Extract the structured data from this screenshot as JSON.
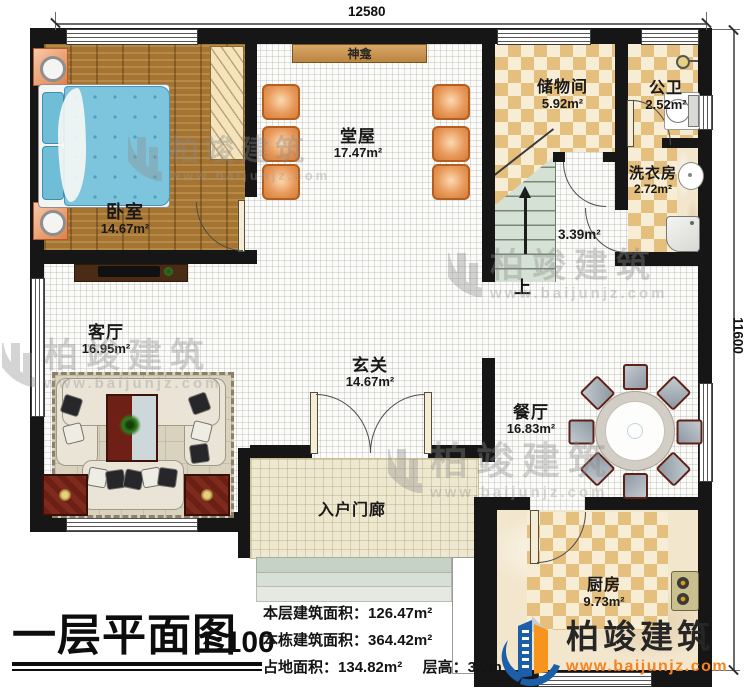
{
  "dimensions": {
    "top": "12580",
    "right": "11600"
  },
  "rooms": {
    "bedroom": {
      "name": "卧室",
      "area": "14.67m²"
    },
    "hall": {
      "name": "堂屋",
      "area": "17.47m²"
    },
    "shrine": {
      "name": "神龛"
    },
    "storage": {
      "name": "储物间",
      "area": "5.92m²"
    },
    "public_bath": {
      "name": "公卫",
      "area": "2.52m²"
    },
    "laundry": {
      "name": "洗衣房",
      "area": "2.72m²"
    },
    "stairwell": {
      "area": "3.39m²",
      "direction": "上"
    },
    "living": {
      "name": "客厅",
      "area": "16.95m²"
    },
    "foyer": {
      "name": "玄关",
      "area": "14.67m²"
    },
    "dining": {
      "name": "餐厅",
      "area": "16.83m²"
    },
    "kitchen": {
      "name": "厨房",
      "area": "9.73m²"
    },
    "porch": {
      "name": "入户门廊"
    }
  },
  "title_block": {
    "title": "一层平面图",
    "scale": "1:100"
  },
  "stats": {
    "floor_area": {
      "label": "本层建筑面积：",
      "value": "126.47m²"
    },
    "total_area": {
      "label": "本栋建筑面积：",
      "value": "364.42m²"
    },
    "footprint": {
      "label": "占地面积：",
      "value": "134.82m²"
    },
    "story_height": {
      "label": "层高：",
      "value": "3.9m"
    }
  },
  "branding": {
    "company": "柏竣建筑",
    "website": "www.baijunjz.com"
  },
  "watermark": {
    "company": "柏竣建筑",
    "website": "www.baijunjz.com"
  },
  "colors": {
    "brand_blue": "#1c5fa8",
    "brand_orange": "#f7941d",
    "wall": "#161616",
    "checker_tan": "#e4bf7e",
    "wood": "#ad7a35",
    "stair_green": "#d6e1d5"
  }
}
